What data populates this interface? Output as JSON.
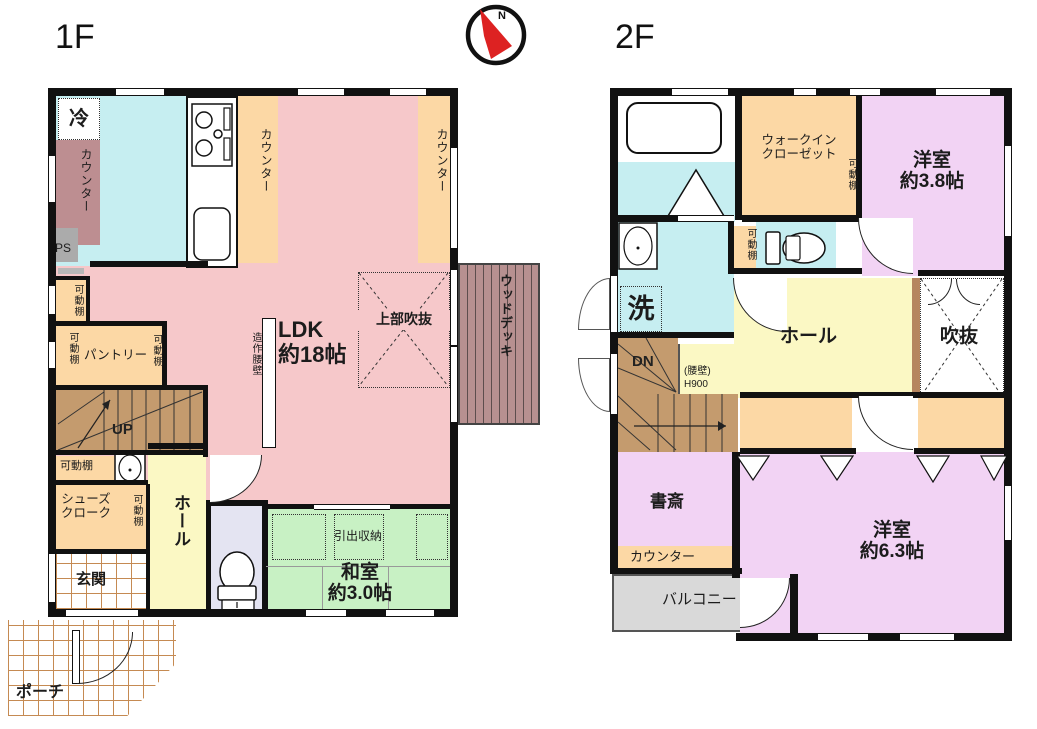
{
  "titles": {
    "floor1": "1F",
    "floor2": "2F"
  },
  "compass": {
    "north": "N"
  },
  "palette": {
    "wall": "#111111",
    "ldk_pink": "#f6c8ca",
    "kitchen_cyan": "#c6eef1",
    "closet_orange": "#fcd8a5",
    "counter_mauve": "#bd8e91",
    "tatami_green": "#c8f1c4",
    "hall_yellow": "#fbf8c4",
    "room_lavender": "#f2d3f4",
    "balcony_gray": "#d9d9d9",
    "stairs_brown": "#c49b6e",
    "deck_brown": "#b79090",
    "toilet_lavender": "#e4e4f2",
    "needle_red": "#dd2222"
  },
  "floor1": {
    "refrigerator": "冷",
    "counter_left": "カウンター",
    "ps": "PS",
    "counter_kitchen_front": "カウンター",
    "counter_window_side": "カウンター",
    "shelf_upper": "可動棚",
    "pantry_shelf_left": "可動棚",
    "pantry": "パントリー",
    "pantry_shelf_right": "可動棚",
    "stairs_up": "UP",
    "ldk": "LDK\n約18帖",
    "partition_wall": "造作腰壁",
    "upper_void": "上部吹抜",
    "wood_deck": "ウッドデッキ",
    "shelf_under_stairs": "可動棚",
    "shoes_closet": "シューズ\nクローク",
    "shoes_closet_shelf": "可動棚",
    "hall": "ホール",
    "entrance": "玄関",
    "tatami_room": "和室\n約3.0帖",
    "drawer_storage": "引出収納",
    "porch": "ポーチ"
  },
  "floor2": {
    "walk_in_closet": "ウォークイン\nクローゼット",
    "wic_shelf": "可動棚",
    "western_room_38": "洋室\n約3.8帖",
    "washroom_shelf": "可動棚",
    "laundry": "洗",
    "stairs_down": "DN",
    "knee_wall": "(腰壁)\nH900",
    "hall": "ホール",
    "void": "吹抜",
    "study": "書斎",
    "counter": "カウンター",
    "balcony": "バルコニー",
    "western_room_63": "洋室\n約6.3帖"
  }
}
